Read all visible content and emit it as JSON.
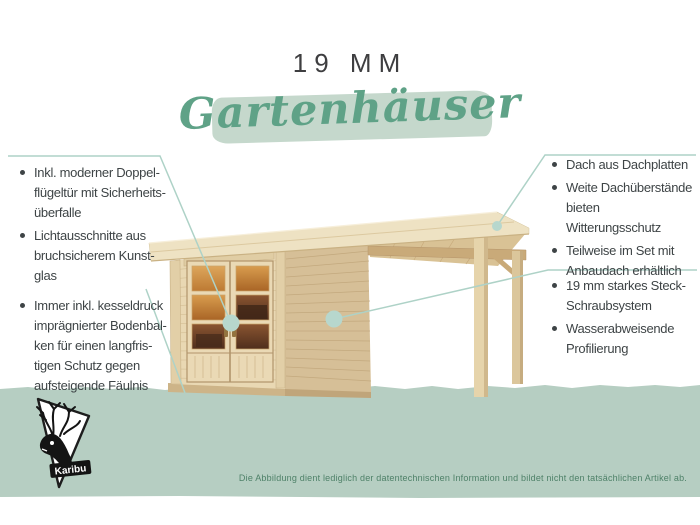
{
  "header": {
    "size_label": "19 MM",
    "category": "Gartenhäuser"
  },
  "callouts": {
    "door": {
      "items": [
        "Inkl. moderner Doppel-\nflügeltür mit Sicherheits-\nüberfalle",
        "Lichtausschnitte aus\nbruchsicherem Kunst-\nglas"
      ]
    },
    "floor": {
      "items": [
        "Immer inkl. kesseldruck\nimprägnierter Bodenbal-\nken für einen langfris-\ntigen Schutz gegen\naufsteigende Fäulnis"
      ]
    },
    "roof": {
      "items": [
        "Dach aus Dachplatten",
        "Weite Dachüberstände\nbieten Witterungsschutz",
        "Teilweise im Set mit\nAnbaudach erhältlich"
      ]
    },
    "walls": {
      "items": [
        "19 mm starkes Steck-\nSchraubsystem",
        "Wasserabweisende\nProfilierung"
      ]
    }
  },
  "logo": {
    "label": "Karibu"
  },
  "disclaimer": "Die Abbildung dient lediglich der datentechnischen Information und bildet nicht den tatsächlichen Artikel ab.",
  "colors": {
    "accent_green": "#5fa287",
    "swash_green": "#c5d8cc",
    "ground_green": "#b6cec2",
    "callout_line": "#aed2c7",
    "callout_dot_fill": "#b7d7cd",
    "text_gray": "#3e4446",
    "disclaimer_green": "#4e8168",
    "wood_front": "#e9d8b3",
    "wood_side": "#d6bf97",
    "roof_cream": "#eee2c3",
    "glass_amber": "#c07a30"
  }
}
